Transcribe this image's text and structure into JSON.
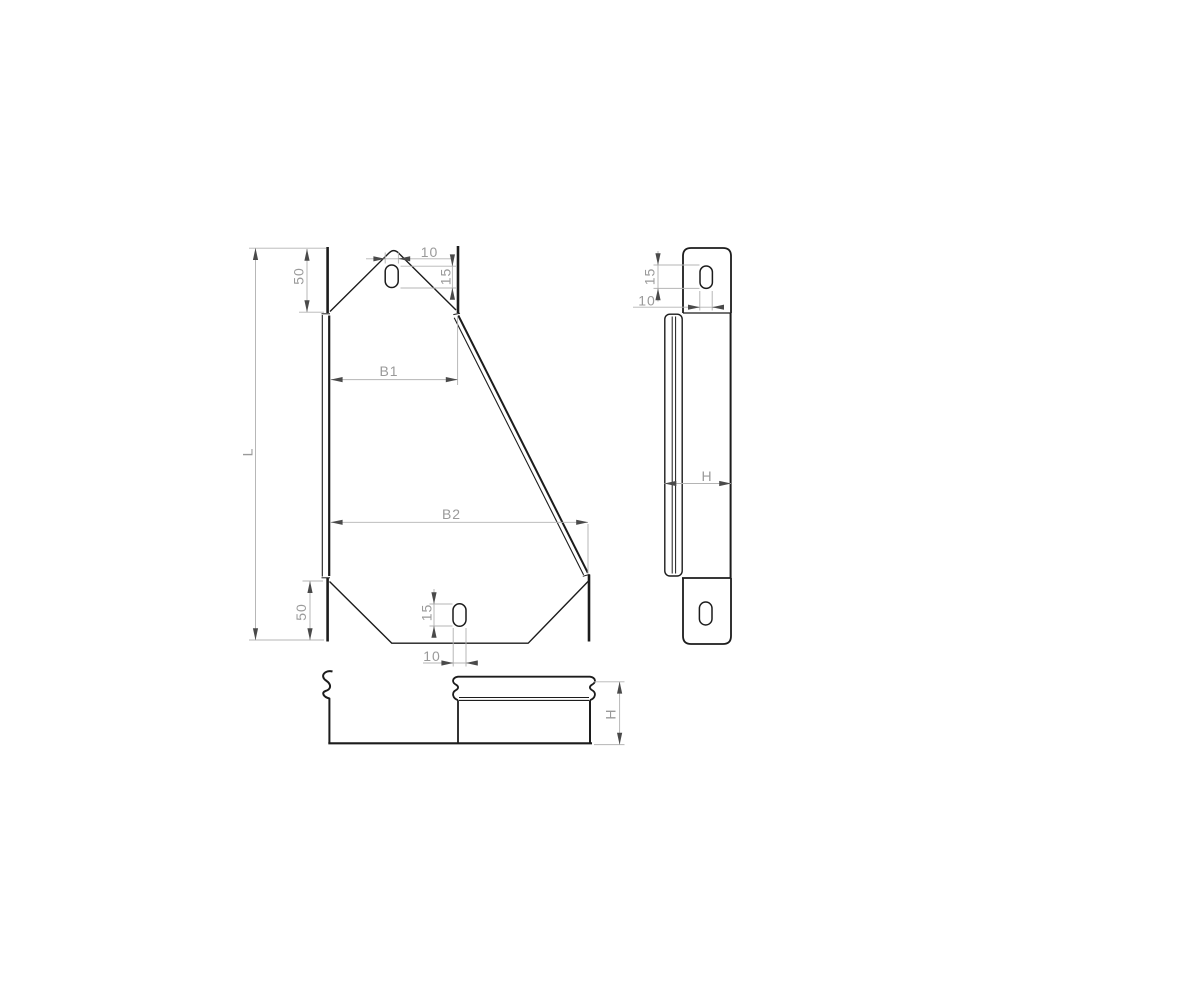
{
  "drawing": {
    "type": "technical-orthographic-drawing",
    "colors": {
      "background": "#ffffff",
      "part_line": "#1c1c1c",
      "dimension_line": "#b4b4b4",
      "arrowhead": "#4a4a4a",
      "dimension_text": "#9a9a9a"
    },
    "labels": {
      "front": {
        "length": "L",
        "offset_top": "50",
        "offset_bottom": "50",
        "width_top": "B1",
        "width_bottom": "B2",
        "slot_top_width": "10",
        "slot_top_length": "15",
        "slot_bottom_length": "15",
        "slot_bottom_width": "10"
      },
      "side": {
        "slot_length": "15",
        "slot_width": "10",
        "height": "H"
      },
      "bottom": {
        "height": "H"
      }
    }
  }
}
